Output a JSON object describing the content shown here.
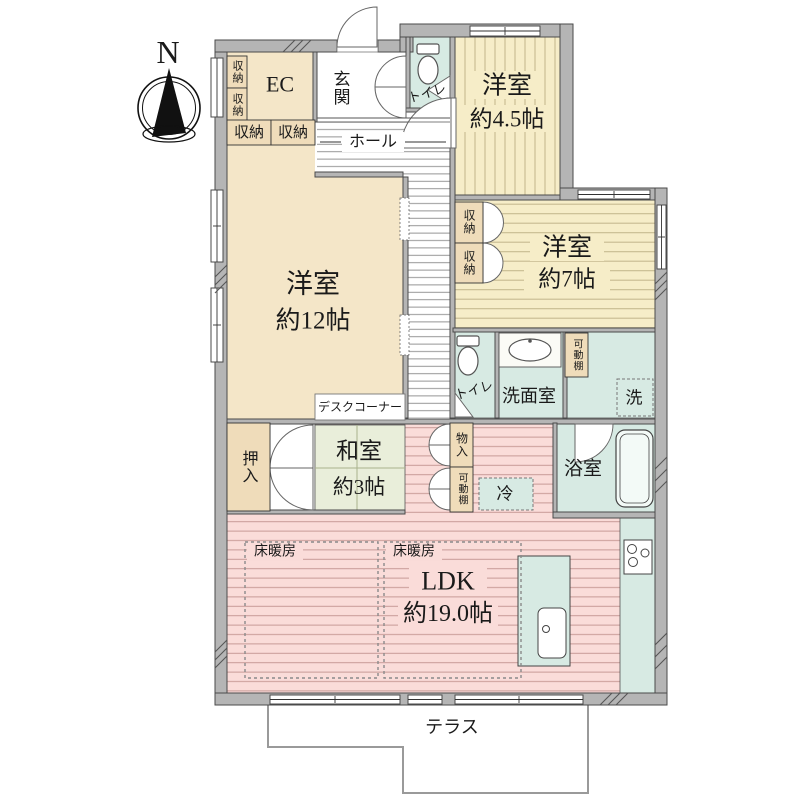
{
  "compass": {
    "north": "N"
  },
  "labels": {
    "ec": "EC",
    "storage": "収納",
    "entrance": "玄関",
    "hall": "ホール",
    "toilet": "トイレ",
    "room45_name": "洋室",
    "room45_size": "約4.5帖",
    "room12_name": "洋室",
    "room12_size": "約12帖",
    "room7_name": "洋室",
    "room7_size": "約7帖",
    "desk_corner": "デスクコーナー",
    "oshiire": "押入",
    "washitsu_name": "和室",
    "washitsu_size": "約3帖",
    "senmenshitsu": "洗面室",
    "kadoudana": "可動棚",
    "laundry": "洗",
    "monoire": "物入",
    "fridge": "冷",
    "bathroom": "浴室",
    "floor_heating": "床暖房",
    "ldk_name": "LDK",
    "ldk_size": "約19.0帖",
    "terrace": "テラス"
  },
  "colors": {
    "wall": "#b5b5b5",
    "room_beige": "#f4e6c8",
    "closet_beige": "#efdcba",
    "room_yellow": "#f6edc8",
    "stripe_yellow": "#c6ba90",
    "sanitary_cyan": "#d7eae3",
    "ldk_pink": "#fadcd9",
    "stripe_pink": "#c2938f",
    "tatami_green": "#e9eeda",
    "hall_stripe": "#8a8a8a"
  }
}
